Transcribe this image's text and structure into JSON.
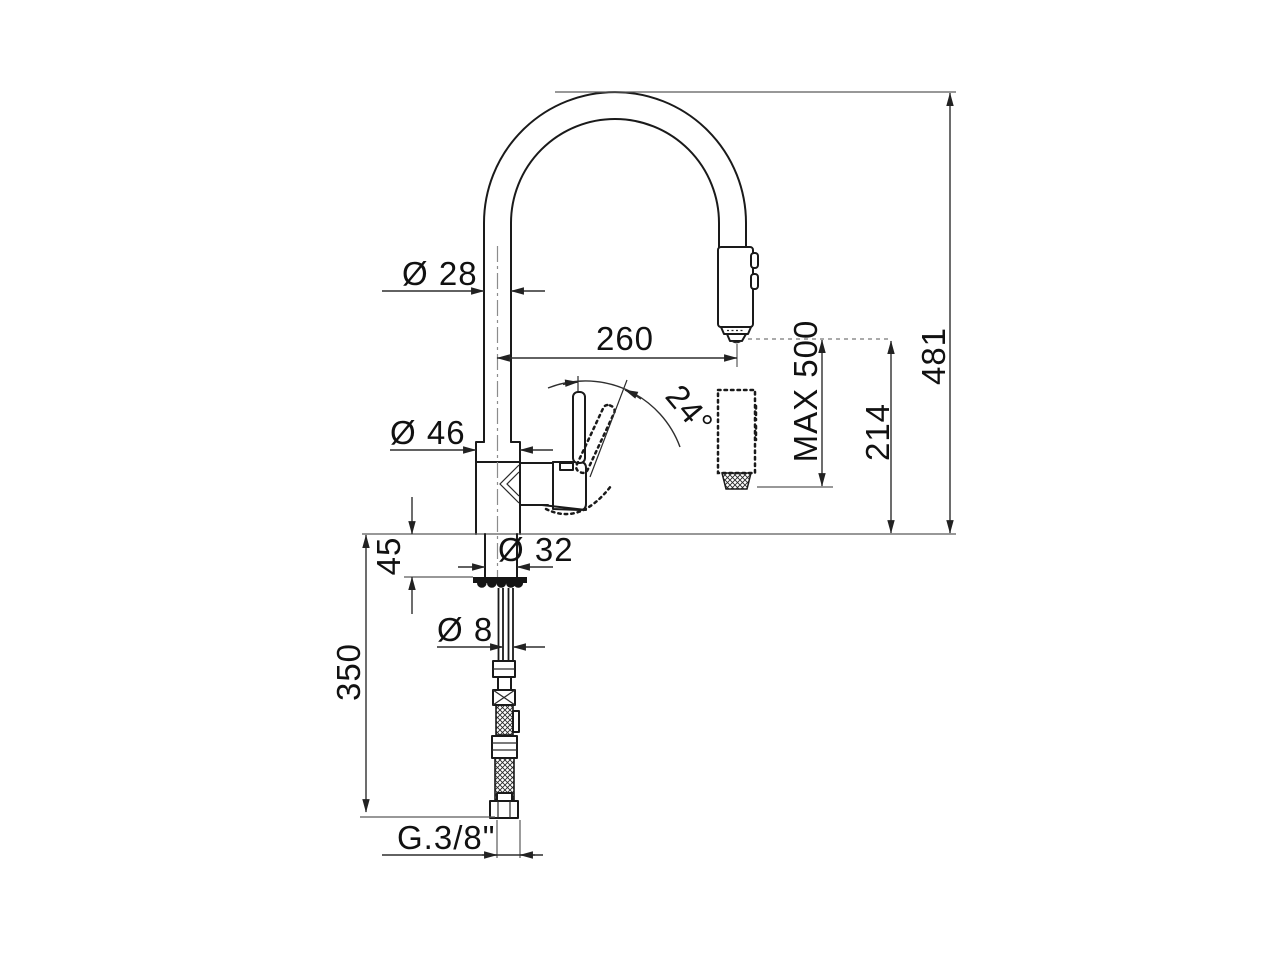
{
  "page": {
    "type": "technical-dimension-drawing",
    "subject": "pull-out-spray-kitchen-mixer-tap",
    "background": "#ffffff"
  },
  "colors": {
    "object_line": "#1a1a1a",
    "dimension_line": "#2f2f2f",
    "extension_line": "#5a5a5a",
    "centerline": "#8c8c8c",
    "text": "#111111"
  },
  "dimensions": {
    "spout_tube_diameter": "Ø 28",
    "spout_reach": "260",
    "overall_height": "481",
    "body_diameter": "Ø 46",
    "handle_swing_angle": "24°",
    "spray_hose_max_extension": "MAX 500",
    "outlet_height": "214",
    "max_deck_thickness": "45",
    "mounting_hole_diameter": "Ø 32",
    "spray_hose_diameter": "Ø 8",
    "supply_hose_length": "350",
    "supply_connection_thread": "G.3/8\""
  }
}
